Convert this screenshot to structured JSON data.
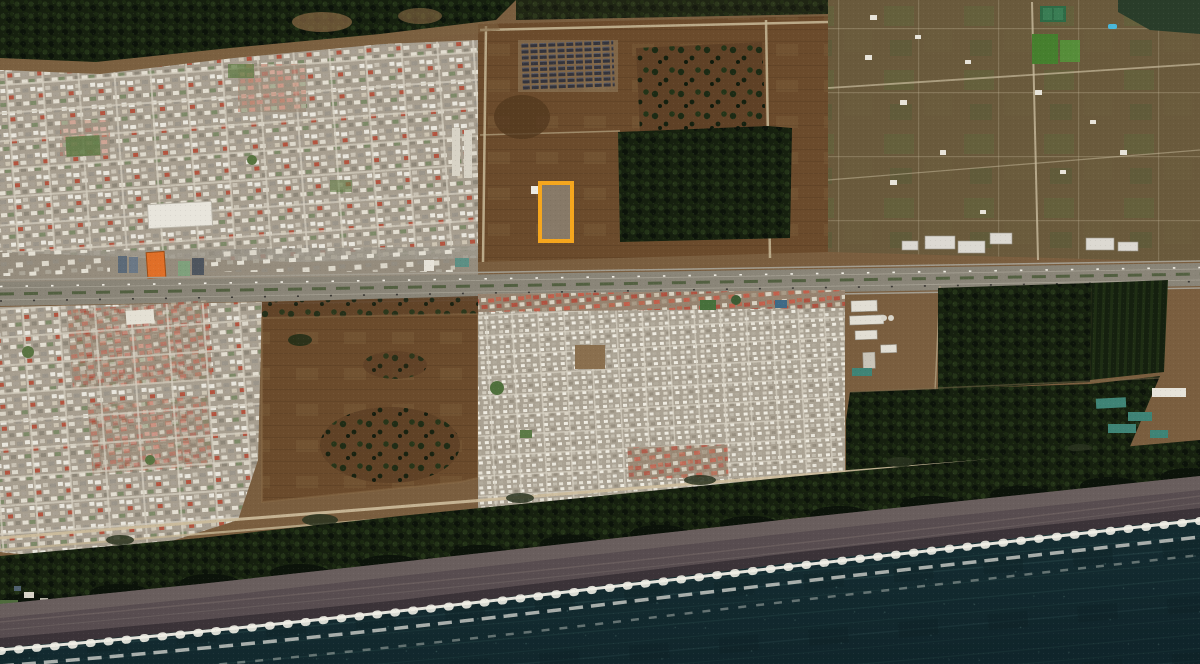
{
  "view": {
    "type": "satellite-aerial-imagery",
    "description": "Oblique satellite view of a coastal town: dense residential grids and brown fields north of a horizontal highway, a large residential grid and pine forest blocks to the south, a dark coastal pine strip, dark-sand beach with breaking surf, and deep teal ocean filling the lower right. One vacant land parcel north of the highway is outlined in orange.",
    "width_px": 1200,
    "height_px": 664,
    "visible_text": "none"
  },
  "annotations": {
    "parcel_highlight": {
      "shape": "rectangle",
      "left_px": 538,
      "top_px": 181,
      "width_px": 36,
      "height_px": 62,
      "border_px": 4,
      "color": "#F5A61E"
    }
  },
  "regions": [
    "forest-top-edge",
    "residential-grid-northwest",
    "construction-rows",
    "central-fields",
    "inland-forest-patch",
    "rural-parcels-northeast",
    "lake-northeast",
    "highway",
    "commercial-strip",
    "orange-roof-building",
    "residential-grid-southwest",
    "central-brown-field",
    "residential-grid-south-central",
    "industrial-sheds",
    "forest-blocks-southeast",
    "plantation-rows",
    "coastal-road",
    "coastal-forest-strip",
    "beach",
    "surf-line",
    "ocean"
  ],
  "colors": {
    "land_base": "#7a5e3f",
    "field": "#6b4b2c",
    "field_dark": "#54391f",
    "forest_dark": "#16200f",
    "forest_deep": "#0c130a",
    "urban_base": "#a79e8f",
    "street": "#d3ccbd",
    "highway": "#8a8578",
    "ocean_deep": "#183338",
    "ocean_mid": "#2c5150",
    "beach_mid": "#584d50",
    "beach_wet": "#352d32",
    "beach_dry": "#6e6360",
    "surf": "#f0eee6",
    "highlight": "#F5A61E",
    "orange_building": "#E06F28",
    "lake": "#2a3d2a",
    "pool": "#49B8DC",
    "sports_green": "#467F2E",
    "teal_roof": "#3F8476",
    "roof_red": "#B05240",
    "roof_white": "#E9E6DD"
  }
}
